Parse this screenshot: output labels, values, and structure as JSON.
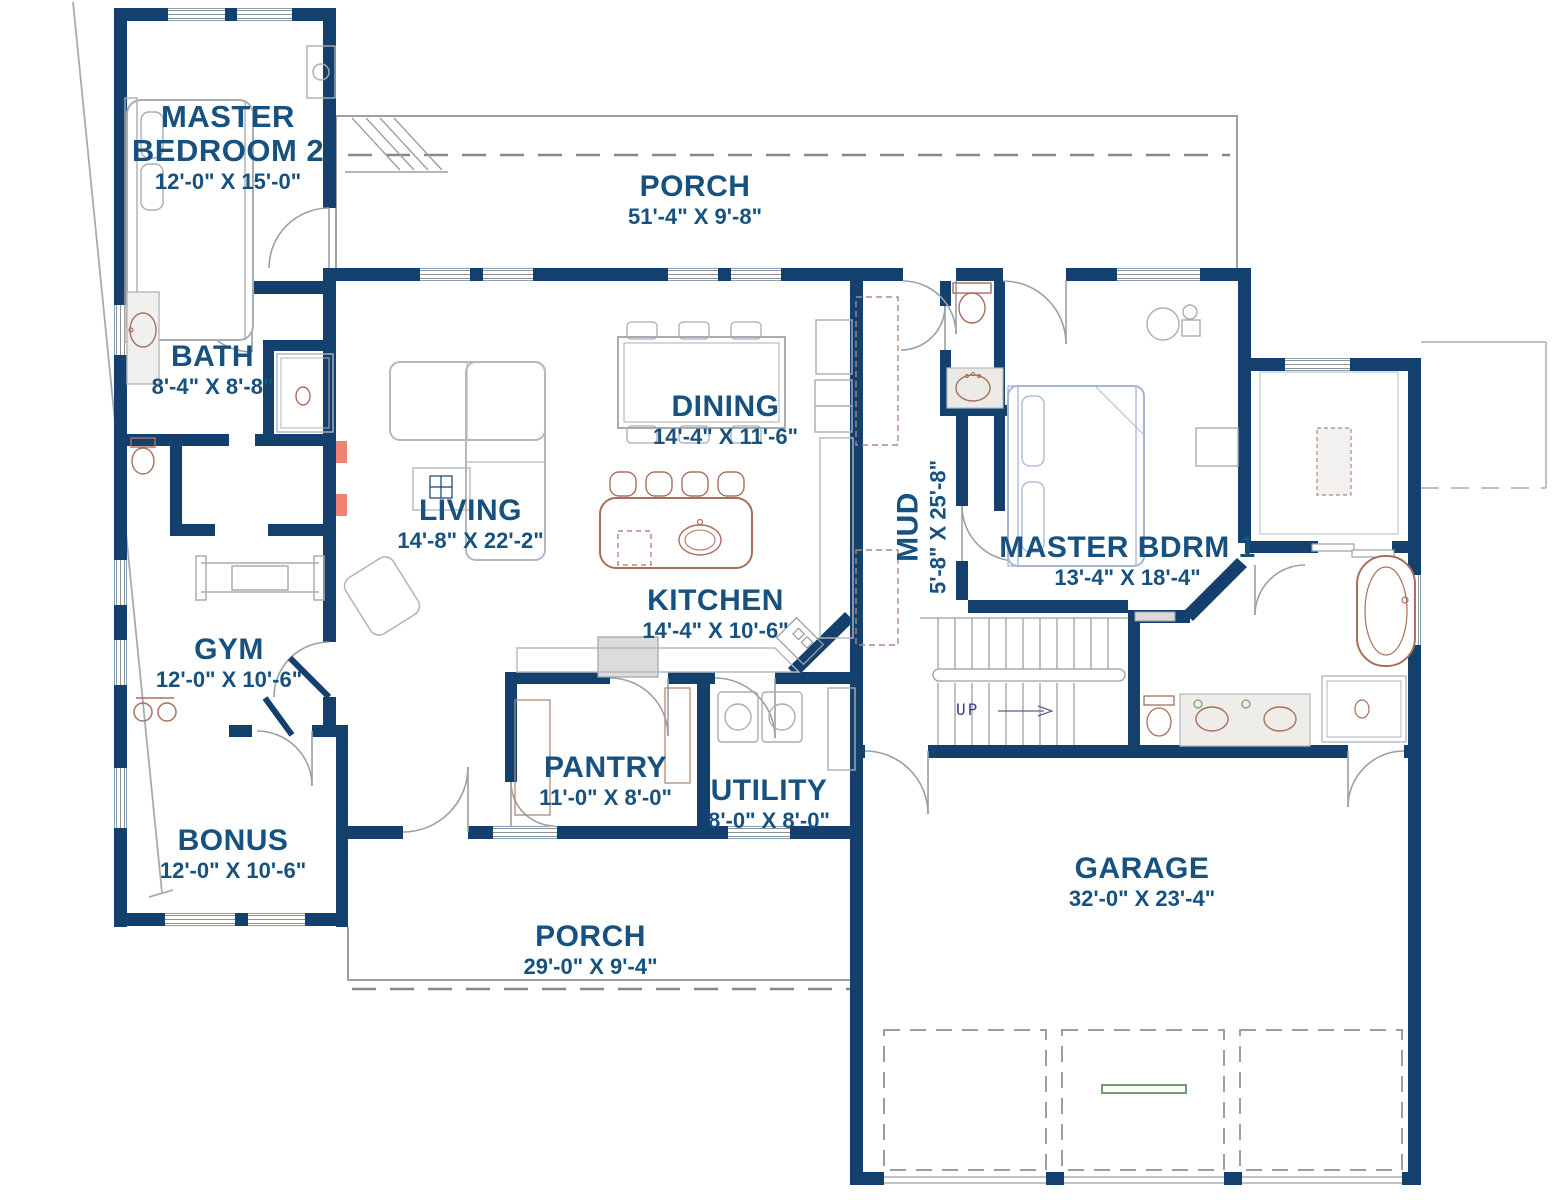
{
  "colors": {
    "wall": "#14406e",
    "label": "#17517f",
    "accent_salmon": "#f08272",
    "garage_marker_green": "#70a070",
    "furniture_blue": "#a9b4d6",
    "furniture_brown": "#a8705c",
    "line_gray": "#9ba0a6"
  },
  "rooms": [
    {
      "name": "MASTER BEDROOM 2",
      "dims": "12'-0\" X 15'-0\""
    },
    {
      "name": "PORCH",
      "dims": "51'-4\" X 9'-8\""
    },
    {
      "name": "BATH",
      "dims": "8'-4\" X 8'-8\""
    },
    {
      "name": "DINING",
      "dims": "14'-4\" X 11'-6\""
    },
    {
      "name": "LIVING",
      "dims": "14'-8\" X 22'-2\""
    },
    {
      "name": "KITCHEN",
      "dims": "14'-4\" X 10'-6\""
    },
    {
      "name": "MUD",
      "dims": "5'-8\" X 25'-8\""
    },
    {
      "name": "MASTER BDRM 1",
      "dims": "13'-4\" X 18'-4\""
    },
    {
      "name": "GYM",
      "dims": "12'-0\" X 10'-6\""
    },
    {
      "name": "PANTRY",
      "dims": "11'-0\" X 8'-0\""
    },
    {
      "name": "UTILITY",
      "dims": "8'-0\" X 8'-0\""
    },
    {
      "name": "BONUS",
      "dims": "12'-0\" X 10'-6\""
    },
    {
      "name": "PORCH",
      "dims": "29'-0\" X 9'-4\""
    },
    {
      "name": "GARAGE",
      "dims": "32'-0\" X 23'-4\""
    }
  ],
  "stairs": {
    "label": "UP"
  }
}
